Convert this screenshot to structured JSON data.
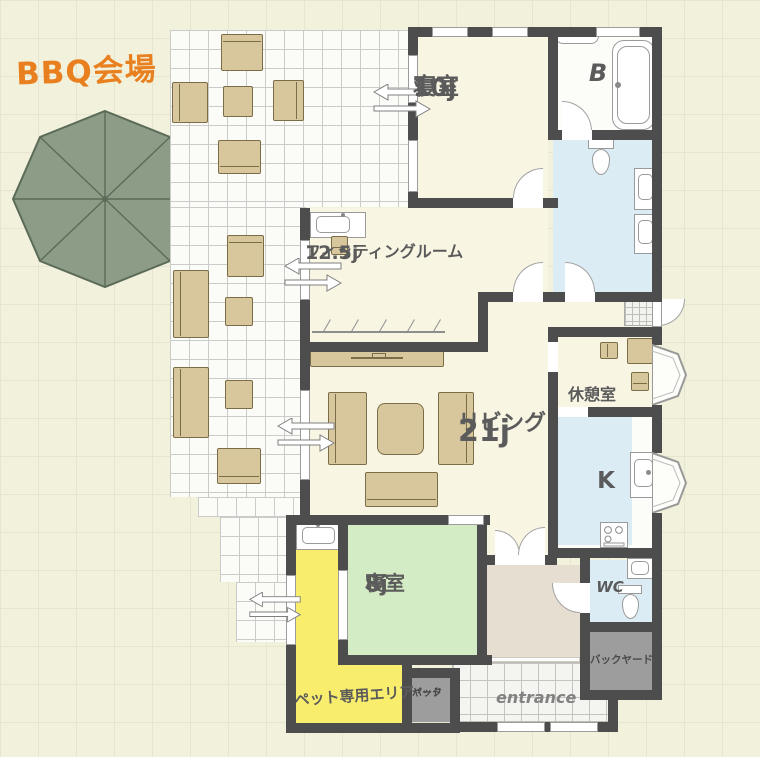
{
  "plan": {
    "outdoor": {
      "bbq_label": "BBQ会場"
    },
    "rooms": {
      "bedroom10": {
        "name": "寝室",
        "size": "10j"
      },
      "bathroom": {
        "name": "B"
      },
      "fitting": {
        "name": "フィッティングルーム",
        "size": "12.5j"
      },
      "rest": {
        "name": "休憩室"
      },
      "living": {
        "name": "リビング",
        "size": "21j"
      },
      "kitchen": {
        "name": "K"
      },
      "bedroom8": {
        "name": "寝室",
        "size": "8j"
      },
      "wc": {
        "name": "WC"
      },
      "backyard": {
        "name": "バックヤード"
      },
      "backyard_small": {
        "line1": "バック",
        "line2": "ヤード"
      },
      "entrance": {
        "name": "entrance"
      },
      "pet": {
        "name": "ペット専用エリア"
      }
    },
    "colors": {
      "bg": "#f2f1dc",
      "bggrid": "#e6e5d0",
      "wall": "#4d4d4d",
      "floor": "#f8f5e3",
      "water": "#dcecf5",
      "green": "#d4ecc5",
      "yellow": "#f8ed6d",
      "gray": "#9d9d9d",
      "hall": "#e5ded1",
      "tan": "#d8c79d",
      "tanb": "#7c6d49",
      "umbrella": "#8d9c86",
      "umbrella_line": "#5c6b59",
      "orange": "#e8801f",
      "text": "#5b5b5b"
    }
  }
}
